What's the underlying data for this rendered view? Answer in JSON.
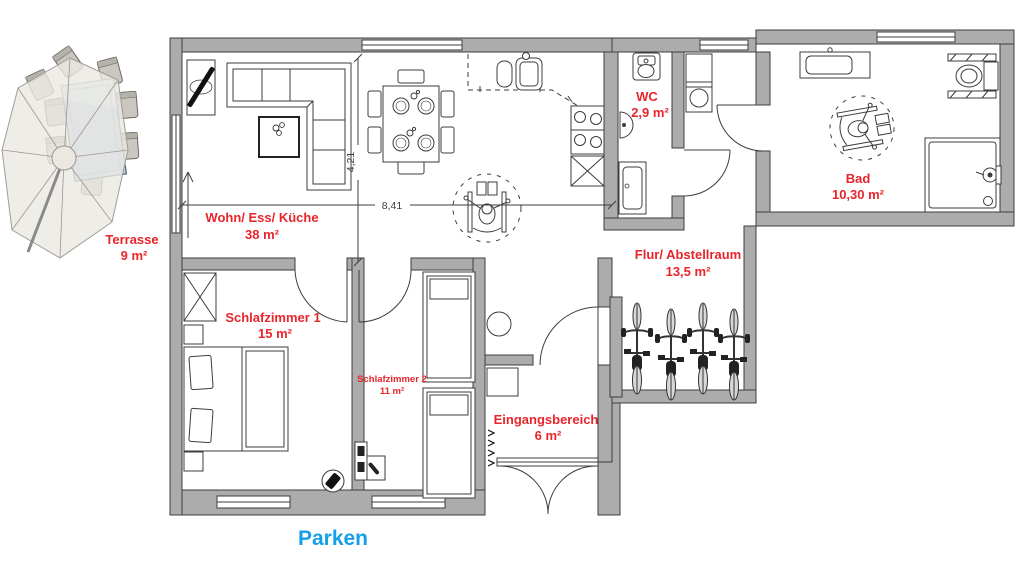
{
  "palette": {
    "label_red": "#e8252b",
    "parken_blue": "#149fe8",
    "wall_gray": "#acacac",
    "umbrella_beige": "#ebe8e2",
    "table_blue": "#b7d0e3",
    "chair_gray": "#cac7c0",
    "wheel_gray": "#d8d8d8"
  },
  "rooms": [
    {
      "id": "terrasse",
      "name": "Terrasse",
      "area": "9 m²"
    },
    {
      "id": "wohn-ess-kueche",
      "name": "Wohn/ Ess/ Küche",
      "area": "38 m²"
    },
    {
      "id": "wc",
      "name": "WC",
      "area": "2,9 m²"
    },
    {
      "id": "bad",
      "name": "Bad",
      "area": "10,30 m²"
    },
    {
      "id": "flur-abstellraum",
      "name": "Flur/ Abstellraum",
      "area": "13,5 m²"
    },
    {
      "id": "schlafzimmer-1",
      "name": "Schlafzimmer 1",
      "area": "15 m²"
    },
    {
      "id": "schlafzimmer-2",
      "name": "Schlafzimmer 2",
      "area": "11 m²"
    },
    {
      "id": "eingangsbereich",
      "name": "Eingangsbereich",
      "area": "6 m²"
    }
  ],
  "dimensions": {
    "horizontal": "8,41",
    "vertical": "4,21"
  },
  "exterior": {
    "parken": "Parken"
  }
}
